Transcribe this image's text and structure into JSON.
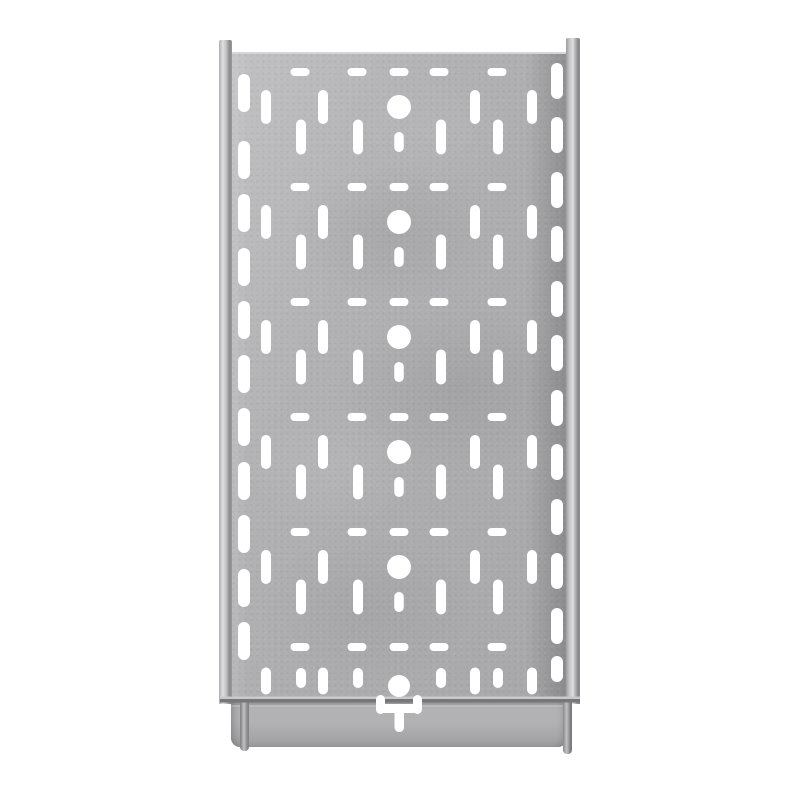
{
  "scene": {
    "type": "product-photo",
    "subject": "Galvanized steel perforated cable tray, straight section, viewed from above on a plain white background",
    "material": "galvanized steel",
    "orientation": "vertical, end flange with coupler cutout at the bottom"
  },
  "palette": {
    "background": "#ffffff",
    "hole": "#ffffff",
    "panel_a": "#c1c1c3",
    "panel_b": "#b2b2b4",
    "panel_c": "#adadaf",
    "panel_d": "#a8a8aa",
    "edge_highlight": "#d6d6d8",
    "flange_top_shadow": "#96979a",
    "flange_mid": "#b2b2b4",
    "flange_low": "#a6a6a8",
    "flange_bottom": "#9b9b9d",
    "rail_light": "#e0e0e2",
    "rail_mid": "#c2c2c4",
    "rail_dark": "#89898b",
    "seam_light": "#c9c9cb",
    "seam_dark": "#77777a",
    "tab_light": "#c2c2c4",
    "tab_dark": "#7d7d7f"
  },
  "tray": {
    "seam": {
      "x": 220,
      "w": 360,
      "y_light": 696.5,
      "h_light": 2.5,
      "y_dark": 699,
      "h_dark": 3.5
    },
    "perforations": {
      "units": 6,
      "unit_period": 115,
      "first_dash_y": 72,
      "dash": {
        "w": 19,
        "h": 8,
        "rx": 4,
        "x_centers": [
          300,
          357,
          399,
          439,
          497
        ]
      },
      "circle": {
        "cx": 399,
        "dy": 35,
        "r": 12
      },
      "long_slots": {
        "w": 10,
        "h": 34,
        "dy": 35,
        "x_centers": [
          266,
          323,
          475,
          532
        ]
      },
      "mid_slots": {
        "w": 10,
        "h": 35,
        "dy": 65,
        "x_centers": [
          301,
          358,
          441,
          498
        ]
      },
      "center_slot": {
        "cx": 399,
        "dy": 70,
        "w": 9.5,
        "h": 20
      },
      "bottom_unit": {
        "circle_cy": 686,
        "circle_r": 11,
        "long_cy": 681,
        "long_h": 27,
        "mid_cy": 678,
        "mid_h": 20
      },
      "left_column": {
        "cx": 244,
        "w": 12,
        "h": 38,
        "y_centers": [
          93,
          160,
          213,
          267,
          320,
          374,
          427,
          481,
          534,
          588,
          641
        ]
      },
      "right_column": {
        "cx": 557,
        "w": 12,
        "h": 36,
        "last_h": 26,
        "y_centers": [
          81,
          135,
          190,
          244,
          299,
          353,
          408,
          462,
          517,
          571,
          626,
          669
        ]
      },
      "t_cutout": {
        "shapes": [
          {
            "x": 376,
            "y": 695,
            "w": 9,
            "h": 19,
            "rx": 4.5
          },
          {
            "x": 413,
            "y": 695,
            "w": 9,
            "h": 19,
            "rx": 4.5
          },
          {
            "x": 376,
            "y": 704,
            "w": 46,
            "h": 9,
            "rx": 4.5
          },
          {
            "x": 394.5,
            "y": 709,
            "w": 9.5,
            "h": 23,
            "rx": 4.5
          }
        ]
      }
    }
  }
}
